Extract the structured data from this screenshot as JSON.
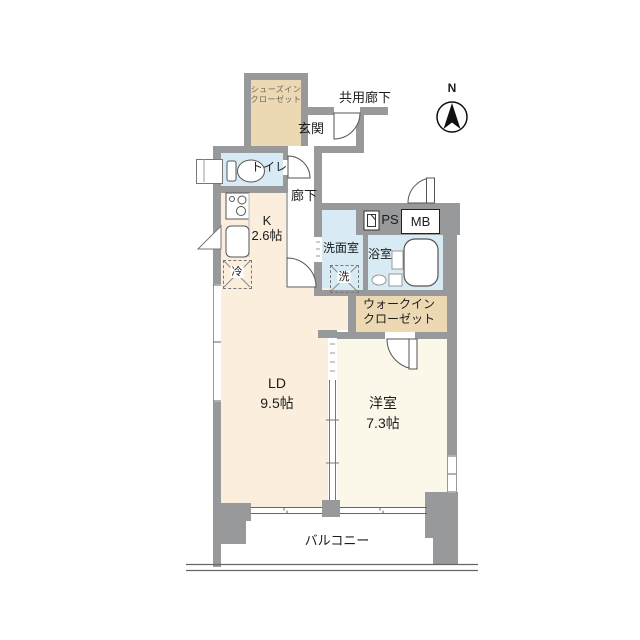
{
  "compass": {
    "north_label": "N"
  },
  "exterior": {
    "common_corridor_label": "共用廊下",
    "balcony_label": "バルコニー"
  },
  "rooms": {
    "shoes_closet": {
      "line1": "シューズイン",
      "line2": "クローゼット"
    },
    "entrance": {
      "label": "玄関"
    },
    "toilet": {
      "label": "トイレ"
    },
    "hallway": {
      "label": "廊下"
    },
    "kitchen": {
      "label": "K",
      "size": "2.6帖"
    },
    "washroom": {
      "label": "洗面室"
    },
    "bathroom": {
      "label": "浴室"
    },
    "walk_in_closet": {
      "line1": "ウォークイン",
      "line2": "クローゼット"
    },
    "living_dining": {
      "label": "LD",
      "size": "9.5帖"
    },
    "western_room": {
      "label": "洋室",
      "size": "7.3帖"
    }
  },
  "fixtures": {
    "refrigerator": "冷",
    "washing_machine": "洗",
    "pipe_space": "PS",
    "meter_box": "MB"
  },
  "icons": {
    "north_arrow": "compass-north-arrow",
    "toilet": "toilet-bowl-icon",
    "bathtub": "bathtub-icon",
    "stove": "stove-burners-icon",
    "sink": "kitchen-sink-icon",
    "door_swings": "quarter-arc-door-symbols"
  },
  "colors": {
    "wall": "#98999b",
    "closet_tan": "#ecd9b4",
    "water_blue": "#d8eaf4",
    "living_cream": "#fbeedd",
    "bedroom_ivory": "#fbf8e9",
    "line": "#555555"
  }
}
